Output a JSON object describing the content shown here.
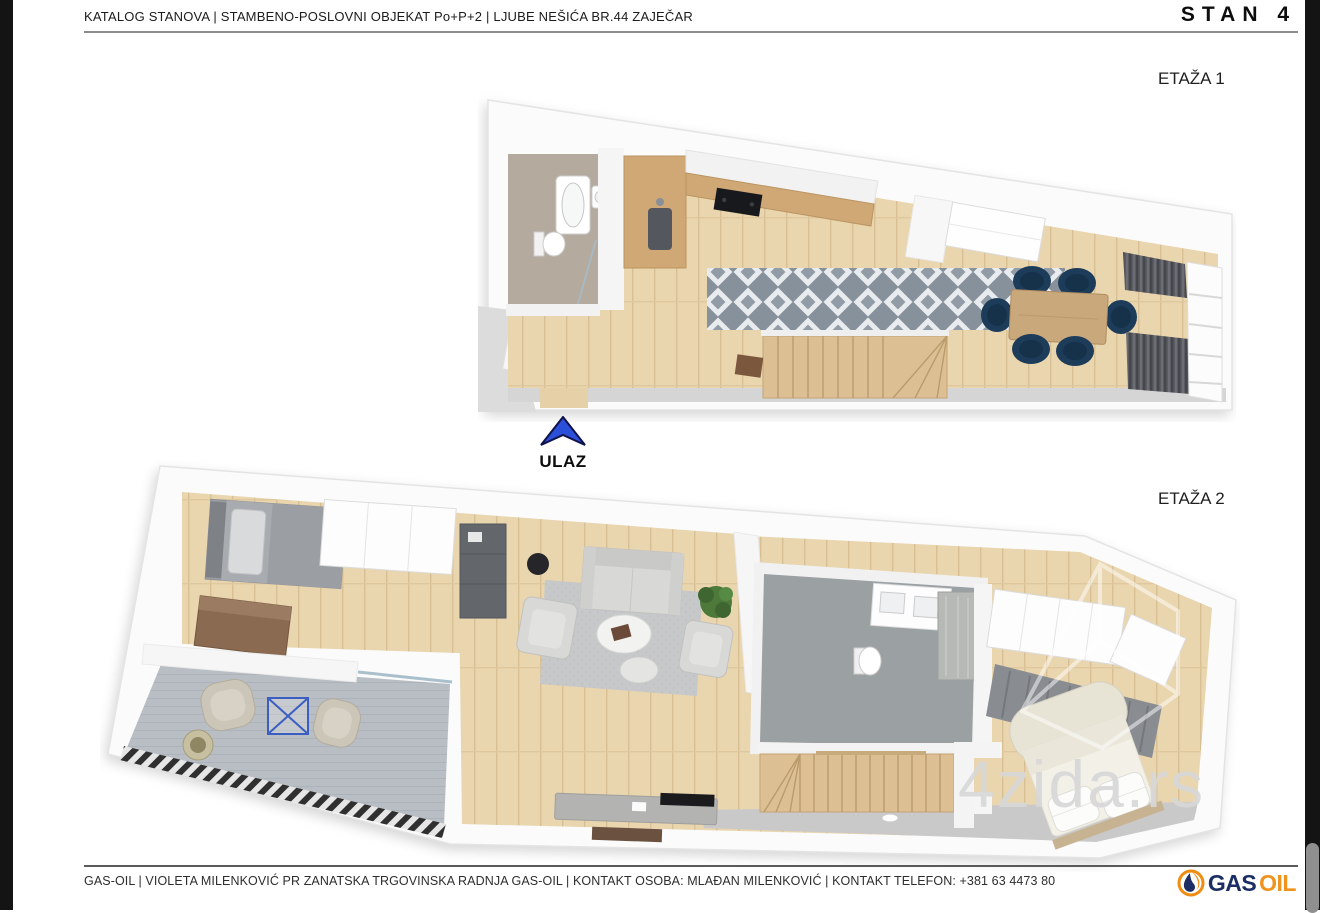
{
  "header": {
    "title": "KATALOG STANOVA | STAMBENO-POSLOVNI OBJEKAT Po+P+2 | LJUBE NEŠIĆA BR.44 ZAJEČAR",
    "unit_label": "STAN 4"
  },
  "floors": [
    {
      "label": "ETAŽA 1"
    },
    {
      "label": "ETAŽA 2"
    }
  ],
  "entrance": {
    "label": "ULAZ",
    "icon": "up-arrow-icon",
    "arrow_color": "#2a50d9"
  },
  "watermark": {
    "text": "4zida.rs",
    "color": "#d8d8d8"
  },
  "footer": {
    "text": "GAS-OIL | VIOLETA MILENKOVIĆ PR ZANATSKA TRGOVINSKA RADNJA GAS-OIL | KONTAKT OSOBA: MLAĐAN MILENKOVIĆ | KONTAKT TELEFON: +381 63 4473 80",
    "logo": {
      "gas": "GAS",
      "oil": "OIL",
      "icon": "oil-drop-icon",
      "navy": "#1c2e63",
      "orange": "#f0921e"
    }
  },
  "palette": {
    "frame": "#141414",
    "wood_floor": "#e9d5ae",
    "dining_chair_navy": "#1d3c5a",
    "rug_lattice_gray": "#929ca6",
    "curtain_gray": "#5a5c61",
    "terrace_rug": "#b9bec5",
    "bathroom_floor": "#9ba0a3"
  }
}
